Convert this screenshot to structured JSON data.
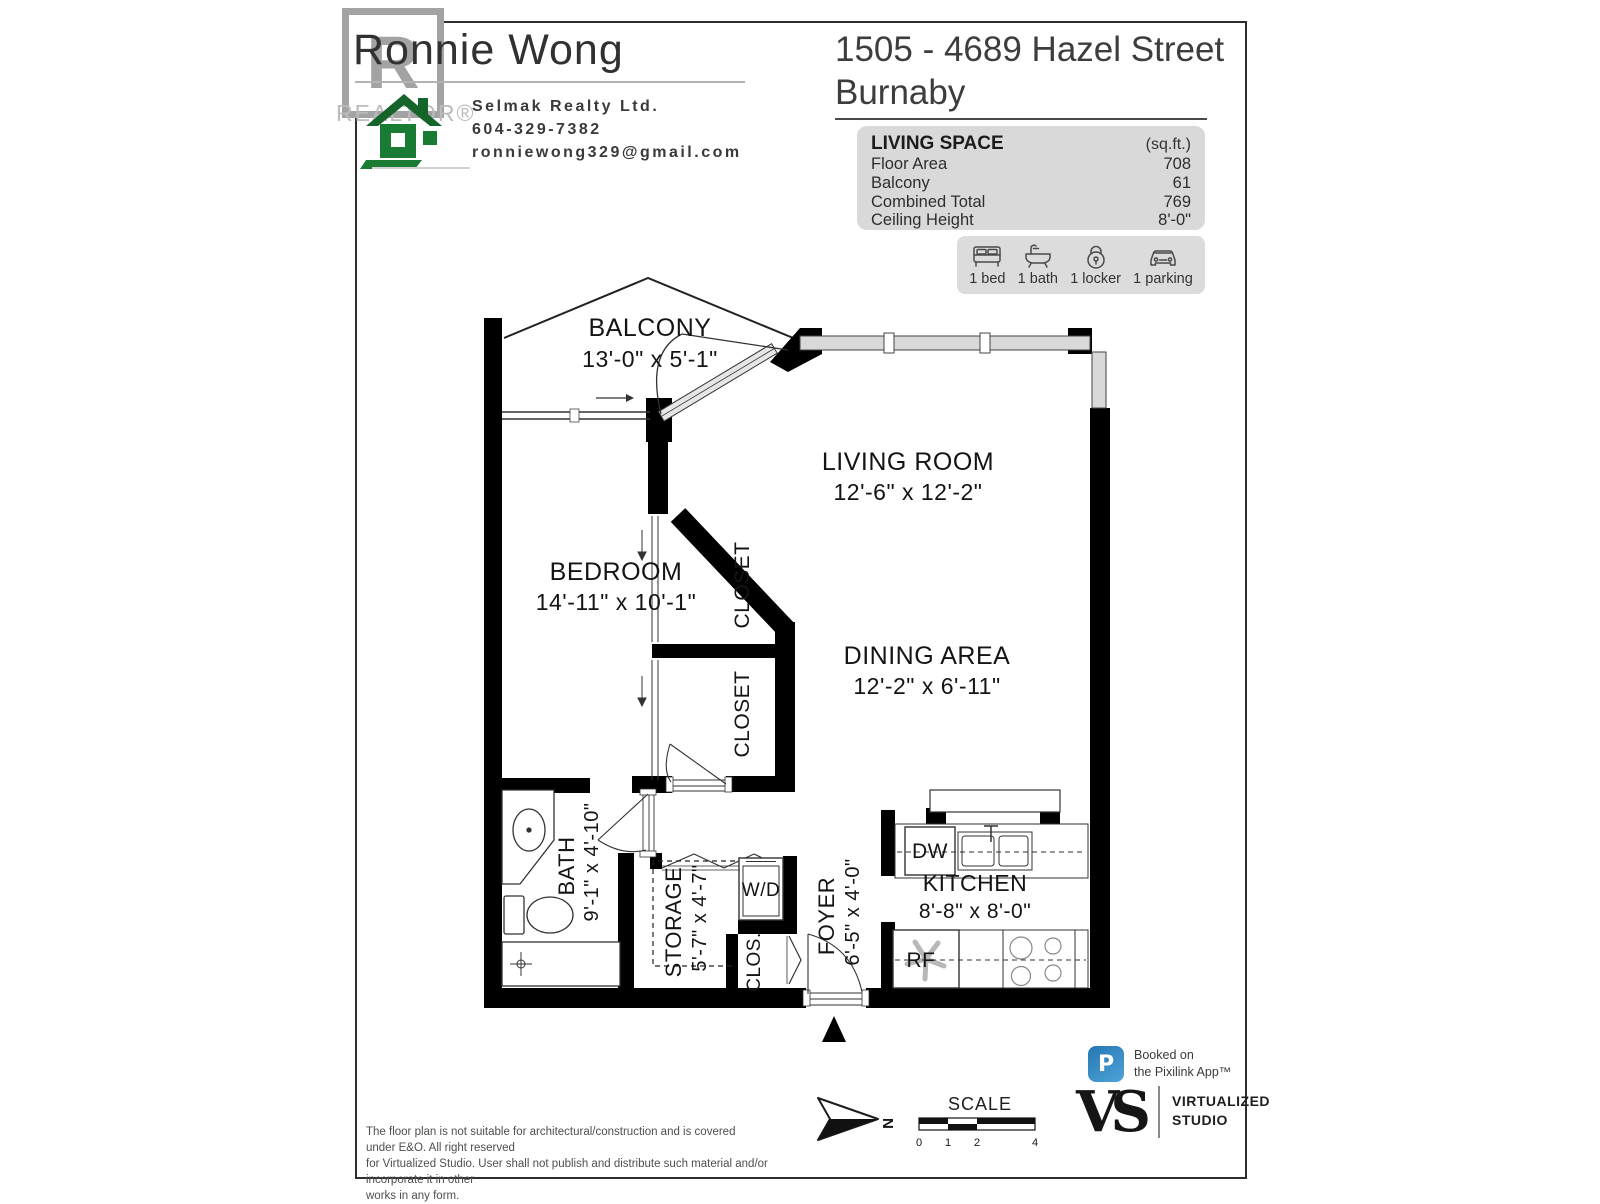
{
  "header": {
    "realtor_r": "R",
    "realtor_word": "REALTOR®",
    "agent_name": "Ronnie Wong",
    "brokerage": "Selmak Realty Ltd.",
    "phone": "604-329-7382",
    "email": "ronniewong329@gmail.com"
  },
  "title": {
    "line1": "1505 - 4689 Hazel Street",
    "line2": "Burnaby"
  },
  "living_space": {
    "heading": "LIVING SPACE",
    "unit_label": "(sq.ft.)",
    "rows": [
      {
        "label": "Floor Area",
        "value": "708"
      },
      {
        "label": "Balcony",
        "value": "61"
      },
      {
        "label": "Combined Total",
        "value": "769"
      },
      {
        "label": "Ceiling Height",
        "value": "8'-0\""
      }
    ]
  },
  "features": [
    {
      "icon": "bed-icon",
      "label": "1 bed"
    },
    {
      "icon": "bath-icon",
      "label": "1 bath"
    },
    {
      "icon": "locker-icon",
      "label": "1 locker"
    },
    {
      "icon": "parking-icon",
      "label": "1 parking"
    }
  ],
  "rooms": {
    "balcony": {
      "name": "BALCONY",
      "dims": "13'-0\" x 5'-1\""
    },
    "living_room": {
      "name": "LIVING ROOM",
      "dims": "12'-6\" x 12'-2\""
    },
    "bedroom": {
      "name": "BEDROOM",
      "dims": "14'-11\" x 10'-1\""
    },
    "closet_top": {
      "name": "CLOSET"
    },
    "closet_bottom": {
      "name": "CLOSET"
    },
    "dining": {
      "name": "DINING AREA",
      "dims": "12'-2\" x 6'-11\""
    },
    "bath": {
      "name": "BATH",
      "dims": "9'-1\" x 4'-10\""
    },
    "storage": {
      "name": "STORAGE",
      "dims": "5'-7\" x 4'-7\""
    },
    "wd": {
      "name": "W/D"
    },
    "clos": {
      "name": "CLOS."
    },
    "foyer": {
      "name": "FOYER",
      "dims": "6'-5\" x 4'-0\""
    },
    "kitchen": {
      "name": "KITCHEN",
      "dims": "8'-8\" x 8'-0\""
    },
    "dw": {
      "name": "DW"
    },
    "rf": {
      "name": "RF"
    }
  },
  "footer": {
    "disclaimer_lines": [
      "The floor plan is not suitable for architectural/construction and is covered under E&O. All right reserved",
      "for Virtualized Studio. User shall not publish and distribute such material and/or incorporate it in other",
      "works in any form."
    ],
    "north_label": "N",
    "scale": {
      "title": "SCALE",
      "ticks": [
        "0",
        "1",
        "2",
        "4"
      ]
    },
    "pixilink": {
      "icon_letter": "P",
      "line1": "Booked on",
      "line2": "the Pixilink App™"
    },
    "studio": {
      "mark": "VS",
      "line1": "VIRTUALIZED",
      "line2": "STUDIO"
    }
  },
  "colors": {
    "wall": "#000000",
    "window": "#d9d9d9",
    "info_box": "#d9d9d9",
    "logo_green": "#1a7c34",
    "pixilink_blue": "#2e81ba"
  }
}
